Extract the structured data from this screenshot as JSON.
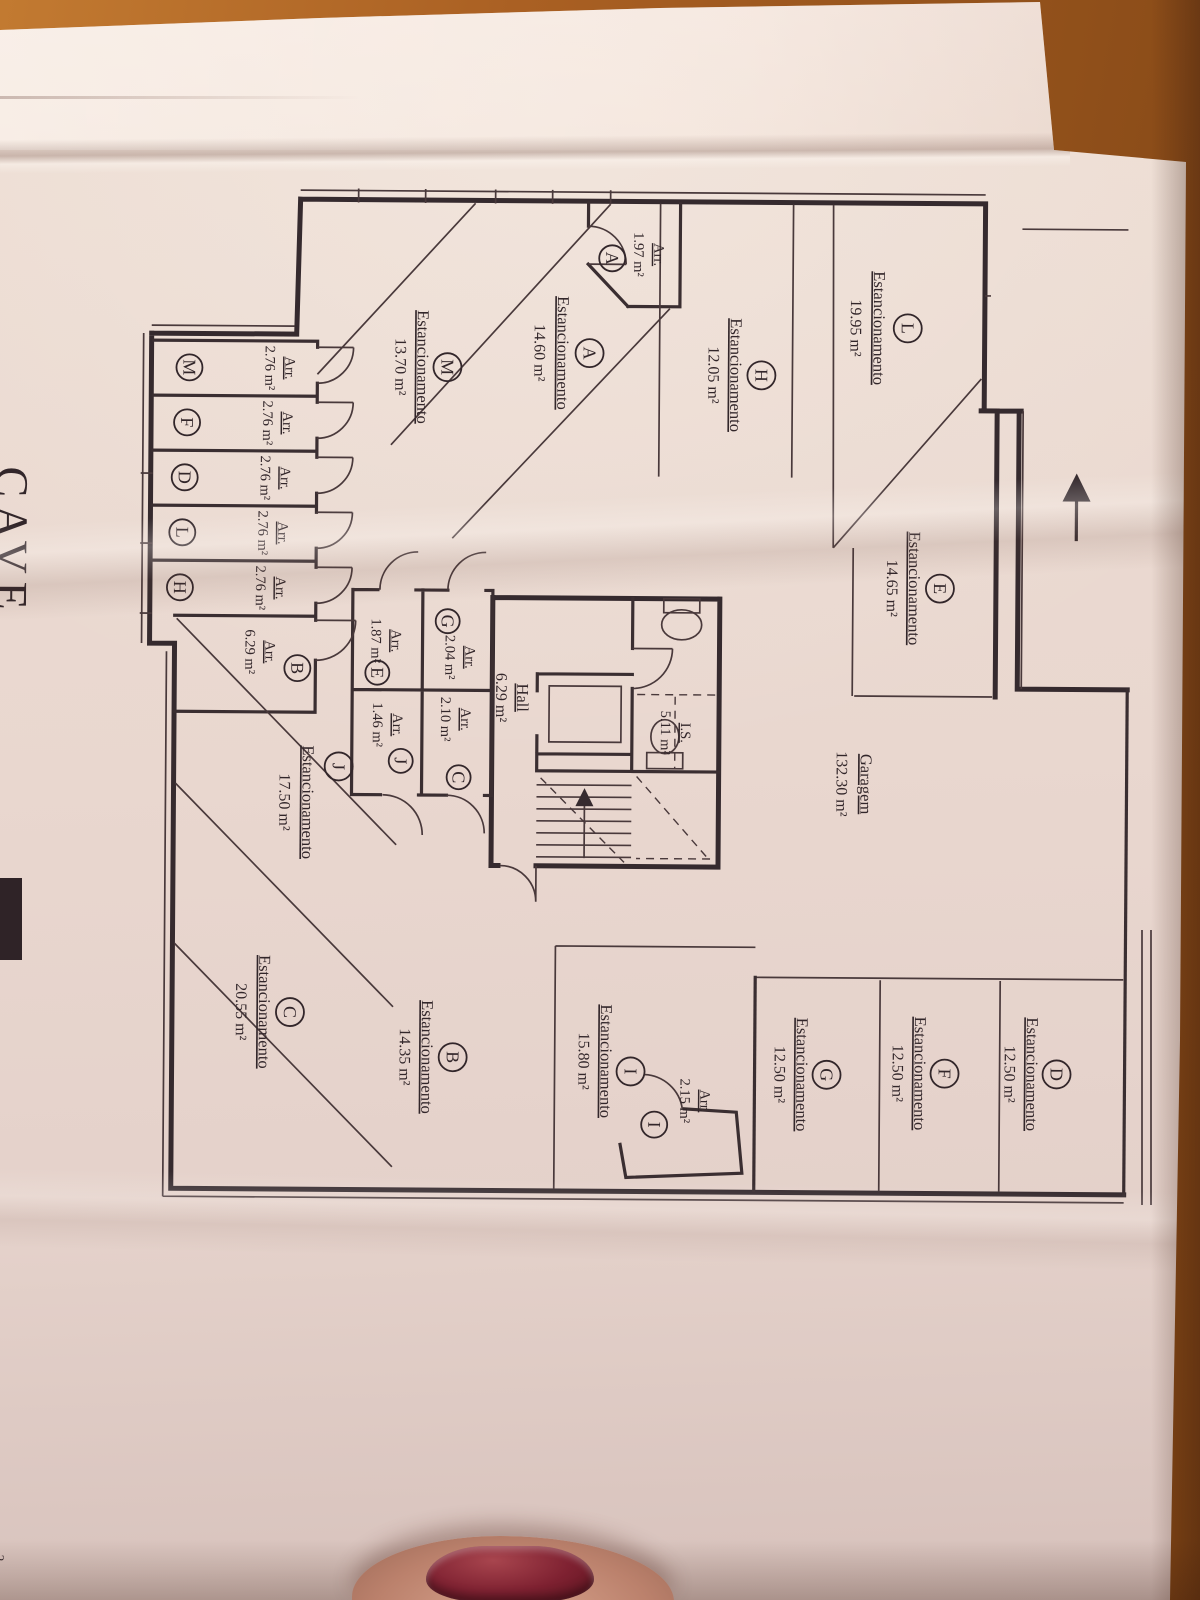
{
  "drawing": {
    "title": "CAVE",
    "corner_fragment": "2",
    "labels": {
      "parking": "Estancionamento",
      "storage": "Arr.",
      "garage": "Garagem",
      "hall": "Hall",
      "wc": "I.S."
    },
    "garage_area": "132.30 m²",
    "hall_area": "6.29 m²",
    "wc_area": "5.11 m²",
    "parking": [
      {
        "letter": "L",
        "area": "19.95 m²"
      },
      {
        "letter": "A",
        "area": "14.60 m²"
      },
      {
        "letter": "H",
        "area": "12.05 m²"
      },
      {
        "letter": "M",
        "area": "13.70 m²"
      },
      {
        "letter": "E",
        "area": "14.65 m²"
      },
      {
        "letter": "J",
        "area": "17.50 m²"
      },
      {
        "letter": "I",
        "area": "15.80 m²"
      },
      {
        "letter": "B",
        "area": "14.35 m²"
      },
      {
        "letter": "C",
        "area": "20.55 m²"
      },
      {
        "letter": "D",
        "area": "12.50 m²"
      },
      {
        "letter": "F",
        "area": "12.50 m²"
      },
      {
        "letter": "G",
        "area": "12.50 m²"
      }
    ],
    "storage": [
      {
        "letter": "A",
        "area": "1.97 m²"
      },
      {
        "letter": "M",
        "area": "2.76 m²"
      },
      {
        "letter": "F",
        "area": "2.76 m²"
      },
      {
        "letter": "D",
        "area": "2.76 m²"
      },
      {
        "letter": "L",
        "area": "2.76 m²"
      },
      {
        "letter": "H",
        "area": "2.76 m²"
      },
      {
        "letter": "B",
        "area": "6.29 m²"
      },
      {
        "letter": "E",
        "area": "1.87 m²"
      },
      {
        "letter": "G",
        "area": "2.04 m²"
      },
      {
        "letter": "J",
        "area": "1.46 m²"
      },
      {
        "letter": "C",
        "area": "2.10 m²"
      },
      {
        "letter": "I",
        "area": "2.15 m²"
      }
    ]
  }
}
